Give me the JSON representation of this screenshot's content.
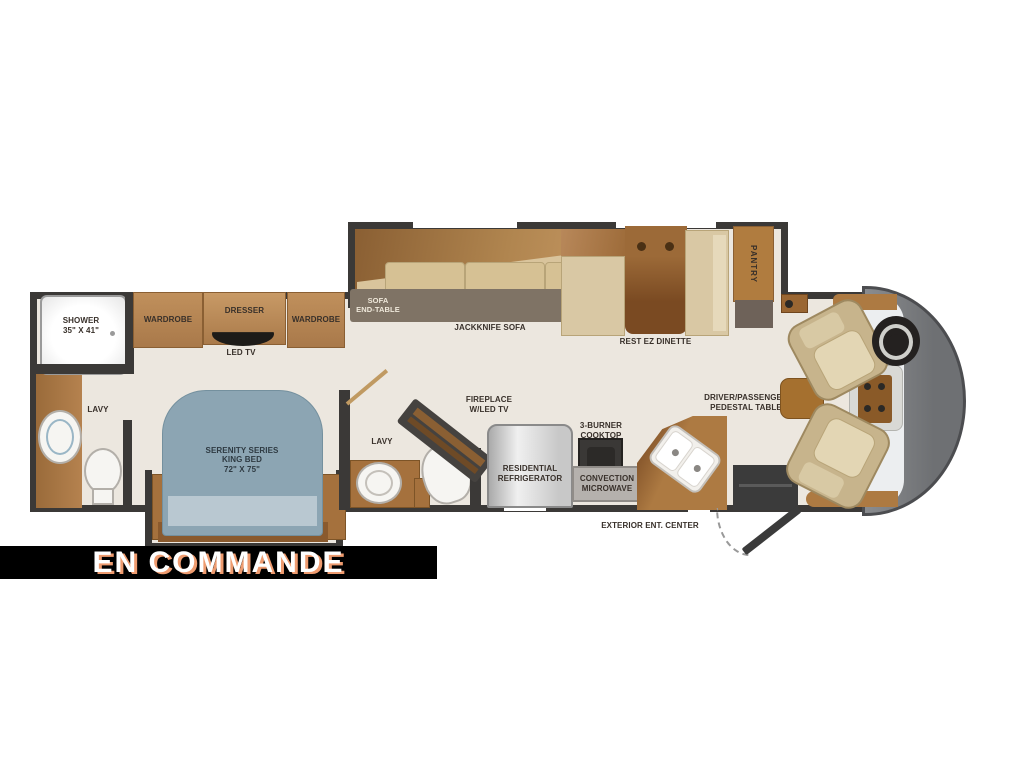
{
  "status_banner": {
    "text": "EN COMMANDE"
  },
  "floorplan": {
    "rear_bath": {
      "lavy": "LAVY",
      "shower": "SHOWER\n35\" X 41\""
    },
    "bedroom": {
      "wardrobe_left": "WARDROBE",
      "dresser": "DRESSER",
      "wardrobe_right": "WARDROBE",
      "led_tv": "LED TV",
      "bed": "SERENITY SERIES\nKING BED\n72\" X 75\""
    },
    "mid_bath": {
      "lavy": "LAVY"
    },
    "living": {
      "sofa_end_table": "SOFA\nEND-TABLE",
      "jackknife_sofa": "JACKKNIFE SOFA",
      "rest_ez_dinette": "REST EZ DINETTE",
      "pantry": "PANTRY",
      "fireplace": "FIREPLACE\nW/LED TV"
    },
    "kitchen": {
      "refrigerator": "RESIDENTIAL\nREFRIGERATOR",
      "cooktop": "3-BURNER\nCOOKTOP",
      "microwave": "CONVECTION\nMICROWAVE"
    },
    "cab": {
      "pedestal_table": "DRIVER/PASSENGER\nPEDESTAL TABLE"
    },
    "exterior": {
      "ent_center": "EXTERIOR ENT. CENTER"
    }
  },
  "colors": {
    "wall": "#3b3937",
    "floor": "#ece7df",
    "cabinet": "#b5824f",
    "cabinet_dark": "#8a5f33",
    "bed_blue": "#8ca5b3",
    "seat_tan": "#d9c8a4",
    "cap_gray": "#77797d",
    "banner_bg": "#000000",
    "banner_text": "#ffffff",
    "banner_shadow": "#ee9b6f"
  }
}
